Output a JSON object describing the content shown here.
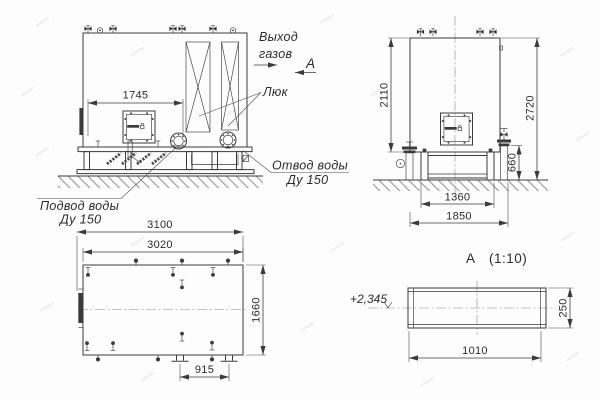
{
  "front_view": {
    "dim_width": "1745",
    "gas_outlet_label_line1": "Выход",
    "gas_outlet_label_line2": "газов",
    "section_label": "А",
    "hatch_label": "Люк",
    "water_outlet_label_line1": "Отвод воды",
    "water_outlet_label_line2": "Ду 150",
    "water_inlet_label_line1": "Подвод воды",
    "water_inlet_label_line2": "Ду 150"
  },
  "side_view": {
    "dim_body_height": "2110",
    "dim_total_height": "2720",
    "dim_base_height": "660",
    "dim_support_width": "1360",
    "dim_base_width": "1850"
  },
  "plan_view": {
    "dim_total_length": "3100",
    "dim_body_length": "3020",
    "dim_body_width": "1660",
    "dim_feet_spacing": "915"
  },
  "detail_a": {
    "view_label": "А",
    "view_scale": "(1:10)",
    "elevation": "+2,345",
    "dim_height": "250",
    "dim_width": "1010"
  },
  "colors": {
    "line": "#3b3b3b",
    "text": "#2b2b2b",
    "ground_hatch": "#9a9a9a",
    "background": "#fdfdfd",
    "watermark": "#e9e9e9"
  }
}
